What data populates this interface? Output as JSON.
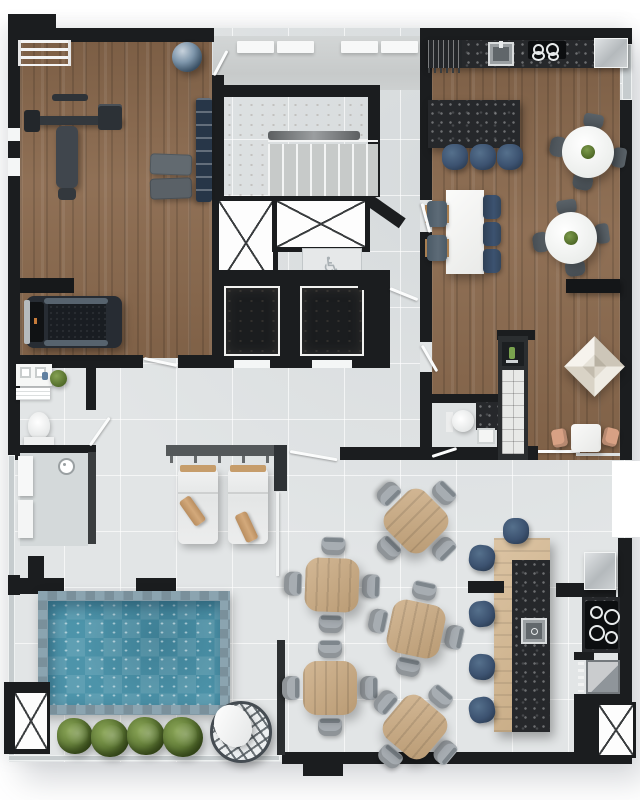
{
  "palette": {
    "wall": "#1b1d1f",
    "wallSoft": "#3a3d3f",
    "tile": "#e2e5e6",
    "concrete": "#cdd0d0",
    "wood": "#8a694d",
    "barWood": "#d3b58c",
    "tableWood": "#c9a87e",
    "stone": "#26282b",
    "water": "#4d94aa",
    "poolEdge": "#8ba4b0",
    "navy": "#3c5270",
    "chair": "#a7adb2",
    "plant": "#5f7a35",
    "peach": "#d8a184",
    "steel": "#b7bcbf",
    "pergola": "#54585a",
    "glass": "#c6ccce",
    "accent": "#c77b3a"
  },
  "symbols": {
    "wheelchair": "♿"
  },
  "furniture": {
    "roof_planks": [
      {
        "x": 237,
        "y": 41
      },
      {
        "x": 277,
        "y": 41
      },
      {
        "x": 341,
        "y": 41
      },
      {
        "x": 381,
        "y": 41
      }
    ],
    "island_stools": [
      {
        "x": 455,
        "y": 157
      },
      {
        "x": 483,
        "y": 157
      },
      {
        "x": 510,
        "y": 157
      }
    ],
    "table_chairs_navy": [
      {
        "x": 492,
        "y": 207
      },
      {
        "x": 492,
        "y": 234
      },
      {
        "x": 492,
        "y": 261
      }
    ],
    "table_chairs_slate": [
      {
        "x": 437,
        "y": 214
      },
      {
        "x": 437,
        "y": 248
      }
    ],
    "round_tables": [
      {
        "x": 588,
        "y": 152,
        "r": 10
      },
      {
        "x": 571,
        "y": 238,
        "r": -8
      }
    ],
    "bar_stools": [
      {
        "x": 516,
        "y": 531,
        "r": 0
      },
      {
        "x": 482,
        "y": 558,
        "r": 8
      },
      {
        "x": 482,
        "y": 614,
        "r": -6
      },
      {
        "x": 482,
        "y": 667,
        "r": 5
      },
      {
        "x": 482,
        "y": 710,
        "r": -10
      }
    ],
    "pool_plants": [
      {
        "x": 75,
        "y": 736,
        "s": 36
      },
      {
        "x": 110,
        "y": 738,
        "s": 38
      },
      {
        "x": 146,
        "y": 736,
        "s": 38
      },
      {
        "x": 183,
        "y": 737,
        "s": 40
      }
    ],
    "dining_sets": [
      {
        "x": 416,
        "y": 521,
        "r": 45
      },
      {
        "x": 332,
        "y": 585,
        "r": 2
      },
      {
        "x": 416,
        "y": 629,
        "r": 12
      },
      {
        "x": 330,
        "y": 688,
        "r": 0
      },
      {
        "x": 415,
        "y": 727,
        "r": 40
      }
    ],
    "counts": {
      "dining_tables": 5,
      "chairs_per_dining_table": 4,
      "bar_stools": 5,
      "island_stools": 3,
      "round_tables": 2,
      "sun_loungers": 2,
      "pool_plants": 4,
      "elevators": 2,
      "x_shafts": 4
    }
  }
}
